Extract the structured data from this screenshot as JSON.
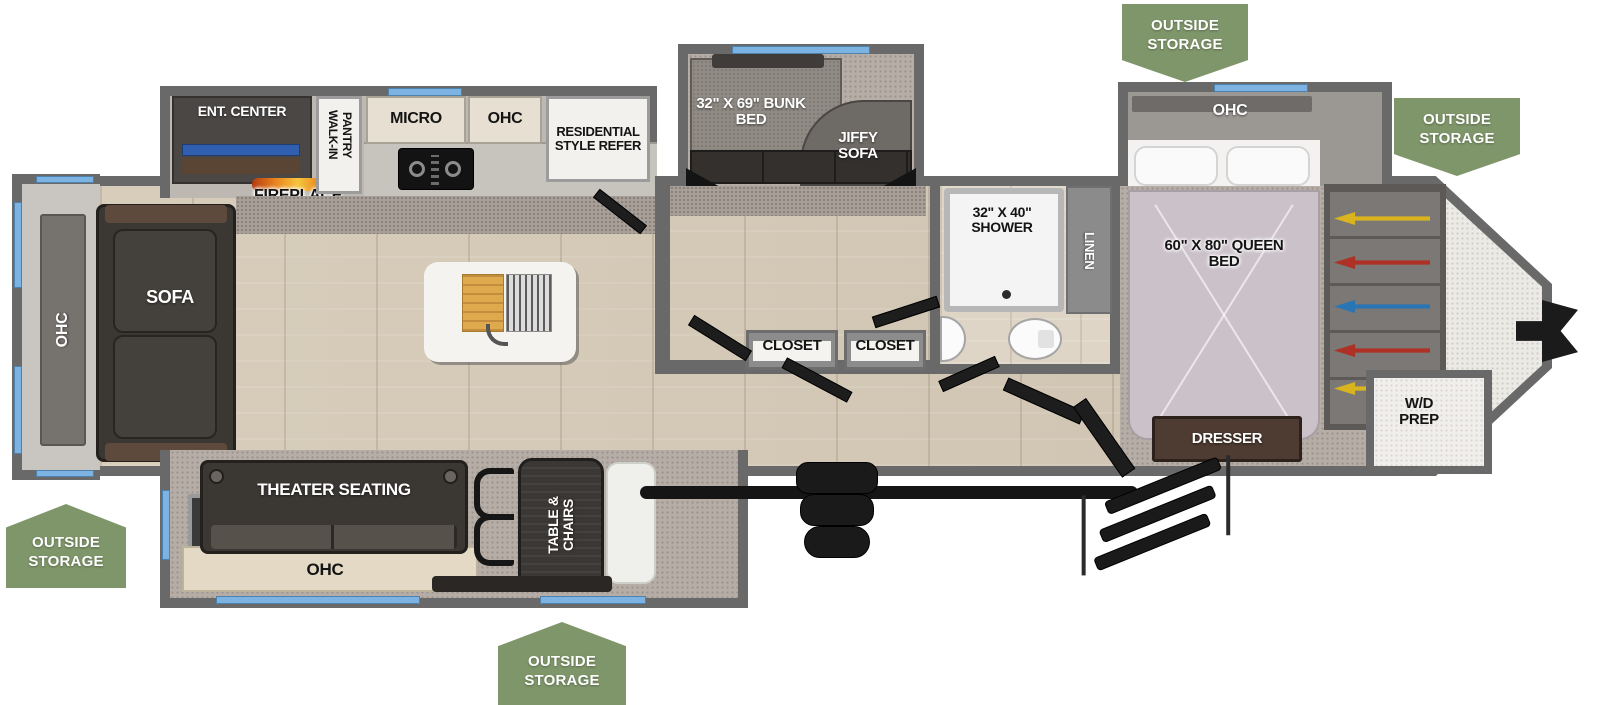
{
  "colors": {
    "storage_badge_green": "#7f966a",
    "window_blue": "#7db3e2",
    "wall_gray": "#696969",
    "wood_floor": "#d5cab8",
    "carpet_gray": "#b6ada6",
    "hanger_yellow": "#d9b41f",
    "hanger_red": "#ad3127",
    "hanger_blue": "#2a76b5"
  },
  "storage_badges": {
    "top_right": "OUTSIDE STORAGE",
    "front_right": "OUTSIDE STORAGE",
    "rear_left": "OUTSIDE STORAGE",
    "bottom_center": "OUTSIDE STORAGE"
  },
  "living_area": {
    "rear_ohc": "OHC",
    "sofa": "SOFA",
    "ent_center": "ENT. CENTER",
    "fireplace": "FIREPLACE",
    "theater_seating": "THEATER SEATING",
    "theater_ohc": "OHC",
    "table_chairs": "TABLE & CHAIRS"
  },
  "kitchen": {
    "walk_in_pantry": "WALK-IN PANTRY",
    "micro": "MICRO",
    "ohc": "OHC",
    "refrigerator": "RESIDENTIAL STYLE REFER"
  },
  "bunk_room": {
    "bunk_bed": "32\" X 69\" BUNK BED",
    "jiffy_sofa": "JIFFY SOFA",
    "closet_left": "CLOSET",
    "closet_right": "CLOSET"
  },
  "bathroom": {
    "shower": "32\" X 40\" SHOWER",
    "linen": "LINEN"
  },
  "bedroom": {
    "ohc": "OHC",
    "queen_bed": "60\" X 80\" QUEEN BED",
    "dresser": "DRESSER",
    "wd_prep": "W/D PREP"
  }
}
